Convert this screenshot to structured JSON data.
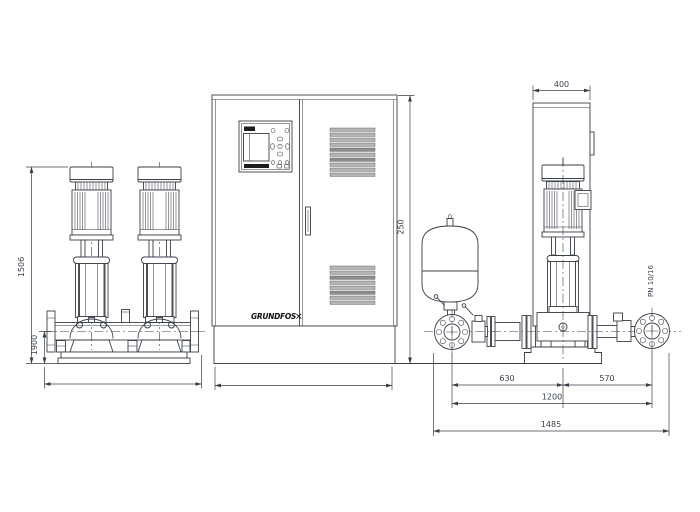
{
  "drawing": {
    "front_view": {
      "dim_total_height": "1506",
      "dim_base_height": "1900"
    },
    "cabinet_front": {
      "logo_text": "GRUNDFOS",
      "logo_mark": "✕",
      "dim_right_vertical": "250"
    },
    "side_view": {
      "dim_cabinet_width": "400",
      "flange_rating": "PN 10/16",
      "dim_suction_to_center": "630",
      "dim_center_to_discharge": "570",
      "dim_flange_to_flange": "1200",
      "dim_overall": "1485"
    },
    "colors": {
      "line": "#3a3f47",
      "grille_fill": "#b5b5b5",
      "panel_dark": "#1d1d1d",
      "background": "#ffffff"
    }
  }
}
